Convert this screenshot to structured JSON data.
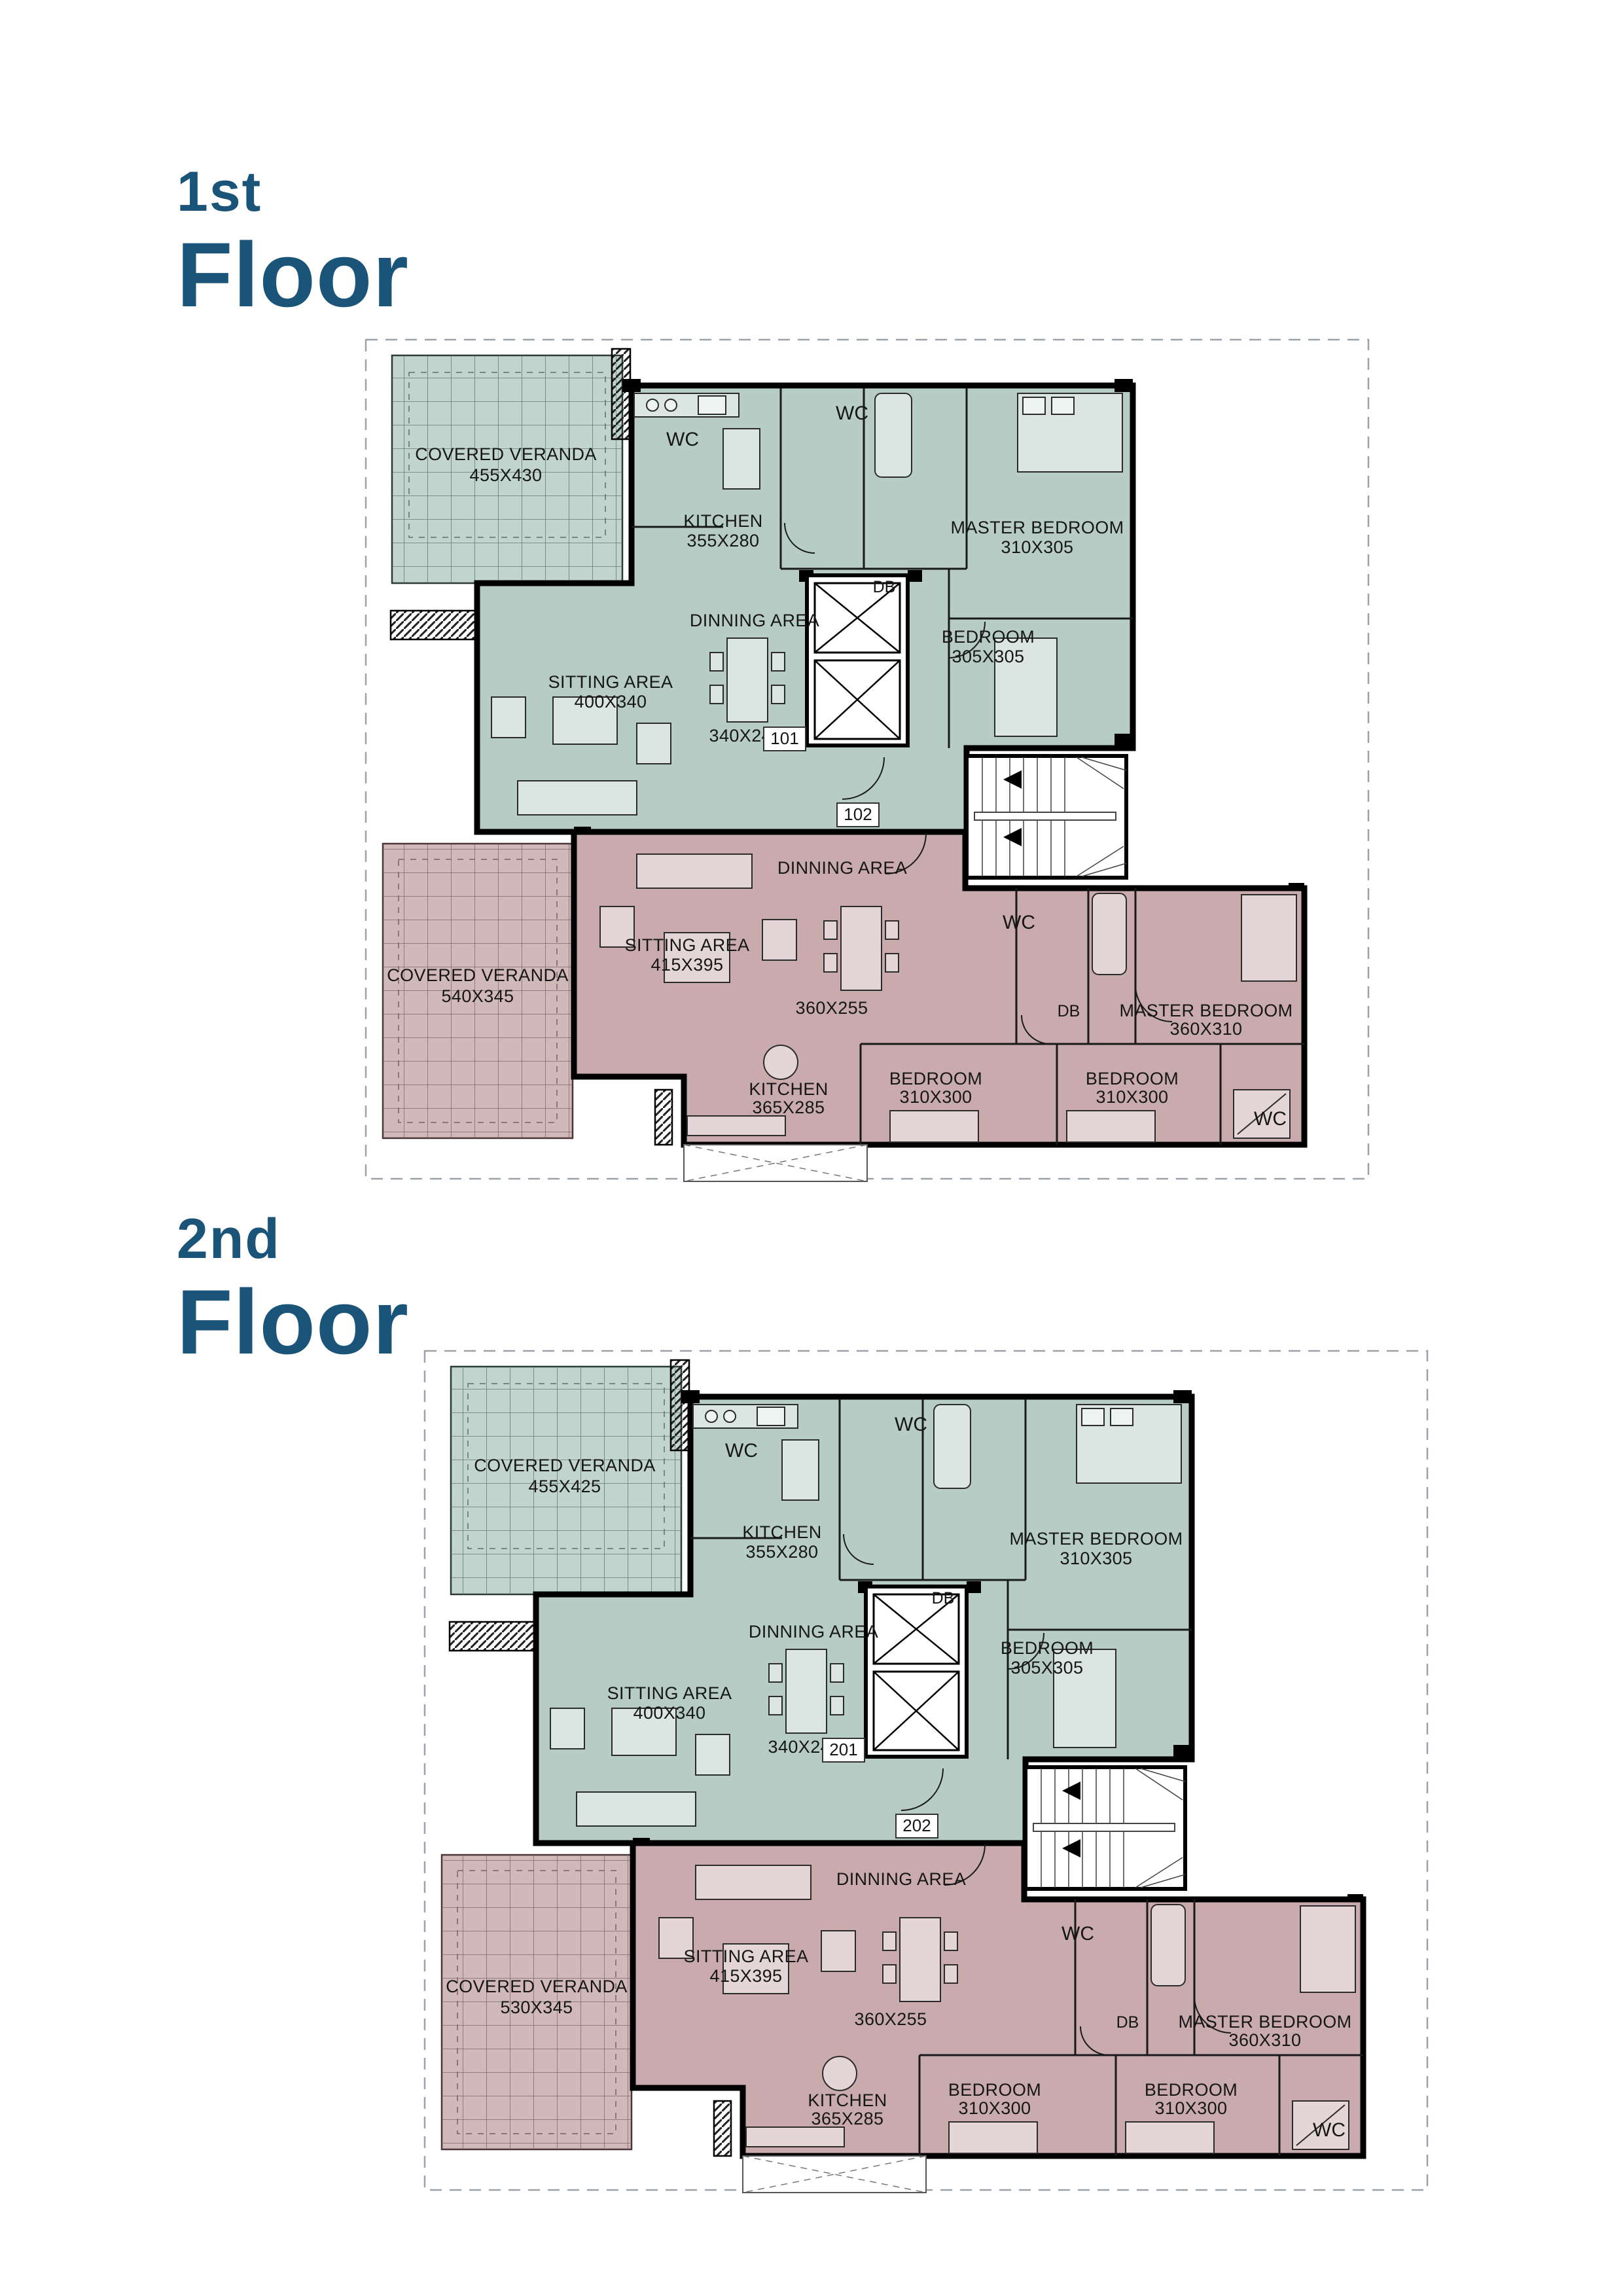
{
  "document_type": "apartment floor plans",
  "colors": {
    "title_blue": "#1A5478",
    "unit_a_fill": "#B6CCC4",
    "unit_b_fill": "#C9ABAD",
    "wall_black": "#000000",
    "background": "#FFFFFF",
    "boundary_dash_gray": "#9AA1A8"
  },
  "floors": [
    {
      "label_small": "1st",
      "label_big": "Floor",
      "unit_a": {
        "number": "101",
        "veranda": {
          "name": "COVERED VERANDA",
          "dims": "455X430"
        },
        "kitchen": {
          "name": "KITCHEN",
          "dims": "355X280"
        },
        "sitting": {
          "name": "SITTING AREA",
          "dims": "400X340"
        },
        "dinning": {
          "name": "DINNING AREA",
          "dims": "340X245"
        },
        "master": {
          "name": "MASTER BEDROOM",
          "dims": "310X305"
        },
        "bedroom": {
          "name": "BEDROOM",
          "dims": "305X305"
        },
        "wc": "WC",
        "db": "DB"
      },
      "unit_b": {
        "number": "102",
        "veranda": {
          "name": "COVERED VERANDA",
          "dims": "540X345"
        },
        "sitting": {
          "name": "SITTING AREA",
          "dims": "415X395"
        },
        "dinning": {
          "name": "DINNING AREA",
          "dims": "360X255"
        },
        "kitchen": {
          "name": "KITCHEN",
          "dims": "365X285"
        },
        "bedroom1": {
          "name": "BEDROOM",
          "dims": "310X300"
        },
        "bedroom2": {
          "name": "BEDROOM",
          "dims": "310X300"
        },
        "master": {
          "name": "MASTER BEDROOM",
          "dims": "360X310"
        },
        "wc": "WC",
        "db": "DB"
      }
    },
    {
      "label_small": "2nd",
      "label_big": "Floor",
      "unit_a": {
        "number": "201",
        "veranda": {
          "name": "COVERED VERANDA",
          "dims": "455X425"
        },
        "kitchen": {
          "name": "KITCHEN",
          "dims": "355X280"
        },
        "sitting": {
          "name": "SITTING AREA",
          "dims": "400X340"
        },
        "dinning": {
          "name": "DINNING AREA",
          "dims": "340X245"
        },
        "master": {
          "name": "MASTER BEDROOM",
          "dims": "310X305"
        },
        "bedroom": {
          "name": "BEDROOM",
          "dims": "305X305"
        },
        "wc": "WC",
        "db": "DB"
      },
      "unit_b": {
        "number": "202",
        "veranda": {
          "name": "COVERED VERANDA",
          "dims": "530X345"
        },
        "sitting": {
          "name": "SITTING AREA",
          "dims": "415X395"
        },
        "dinning": {
          "name": "DINNING AREA",
          "dims": "360X255"
        },
        "kitchen": {
          "name": "KITCHEN",
          "dims": "365X285"
        },
        "bedroom1": {
          "name": "BEDROOM",
          "dims": "310X300"
        },
        "bedroom2": {
          "name": "BEDROOM",
          "dims": "310X300"
        },
        "master": {
          "name": "MASTER BEDROOM",
          "dims": "360X310"
        },
        "wc": "WC",
        "db": "DB"
      }
    }
  ]
}
